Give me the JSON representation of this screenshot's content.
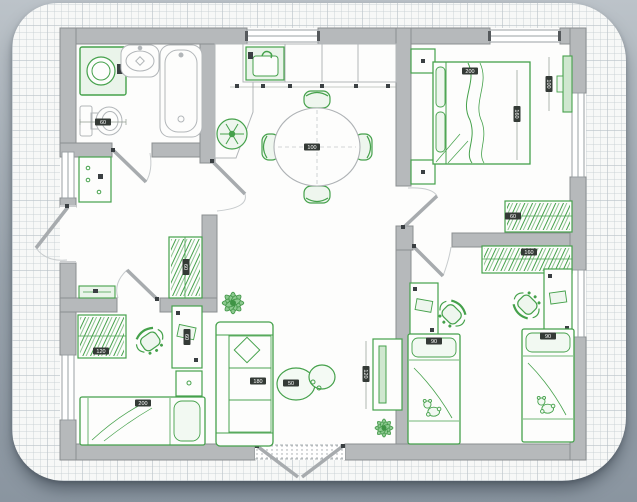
{
  "palette": {
    "background": "#96a0a9",
    "card": "#f7f8f7",
    "grid_line": "#d9dee2",
    "wall_fill": "#b6b9bb",
    "wall_edge": "#8b8e90",
    "furniture_green": "#45a14b",
    "furniture_fill": "#eaf4ea",
    "fixture_gray": "#b2b6b9",
    "label_bg": "#343a36",
    "label_text": "#ffffff"
  },
  "dims": {
    "washer": "60",
    "dining_table": "100",
    "bed_width": "200",
    "bed_length": "160",
    "tv_panel": "100",
    "bedroom_wardrobe": "60",
    "kids_wardrobe": "160",
    "kids_bed_left": "90",
    "kids_bed_right": "90",
    "single_bed": "200",
    "sofa": "180",
    "tv_stand": "120",
    "hall_wardrobe": "60",
    "coffee_table": "50",
    "child_wardrobe": "120",
    "child_desk": "60"
  }
}
